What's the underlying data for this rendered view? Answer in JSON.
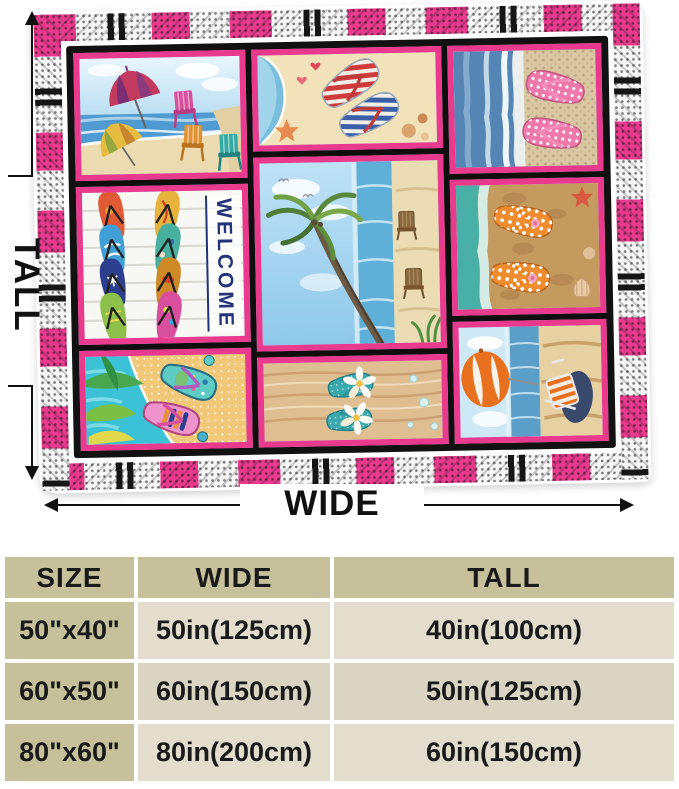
{
  "diagram": {
    "tall_label": "TALL",
    "wide_label": "WIDE"
  },
  "blanket": {
    "welcome_text": "WELCOME",
    "colors": {
      "border_pink": "#e93a8e",
      "frame_black": "#111111",
      "edge_white": "#ffffff"
    },
    "panels": [
      {
        "name": "beach-umbrellas-and-chairs",
        "description": "Red-purple and yellow umbrellas with pink, orange and teal adirondack chairs by the surf"
      },
      {
        "name": "striped-flip-flops-on-sand",
        "description": "Red-white and blue-white striped flip flops on sand with starfish, hearts and shells"
      },
      {
        "name": "pink-polka-dot-flip-flops",
        "description": "Pink polka dot flip flops on pebbled shore beside blue waves"
      },
      {
        "name": "welcome-flip-flop-board",
        "description": "Eight colorful flip flops on white planks with vertical WELCOME lettering"
      },
      {
        "name": "palm-tree-beach",
        "description": "Leaning palm tree over surf with two wooden beach chairs on sand"
      },
      {
        "name": "orange-polka-dot-flip-flops",
        "description": "Orange polka dot flip flops with pink blossoms on brown sand with shells"
      },
      {
        "name": "tropical-flip-flops",
        "description": "Bright patterned flip flops with tropical palm leaves on turquoise water"
      },
      {
        "name": "teal-plumeria-flip-flops",
        "description": "Sparkly teal flip flops with white plumeria flowers on wood"
      },
      {
        "name": "beach-umbrella-and-lounge-chair",
        "description": "Orange and white umbrella with striped lounge chair on the shore"
      }
    ]
  },
  "size_table": {
    "columns": [
      "SIZE",
      "WIDE",
      "TALL"
    ],
    "rows": [
      {
        "size": "50\"x40\"",
        "wide": "50in(125cm)",
        "tall": "40in(100cm)"
      },
      {
        "size": "60\"x50\"",
        "wide": "60in(150cm)",
        "tall": "50in(125cm)"
      },
      {
        "size": "80\"x60\"",
        "wide": "80in(200cm)",
        "tall": "60in(150cm)"
      }
    ],
    "colors": {
      "header_bg": "#c6c09b",
      "row_label_bg": "#c6c09b",
      "cell_bg": "#e2ddcc",
      "text": "#1a1a1a"
    }
  }
}
